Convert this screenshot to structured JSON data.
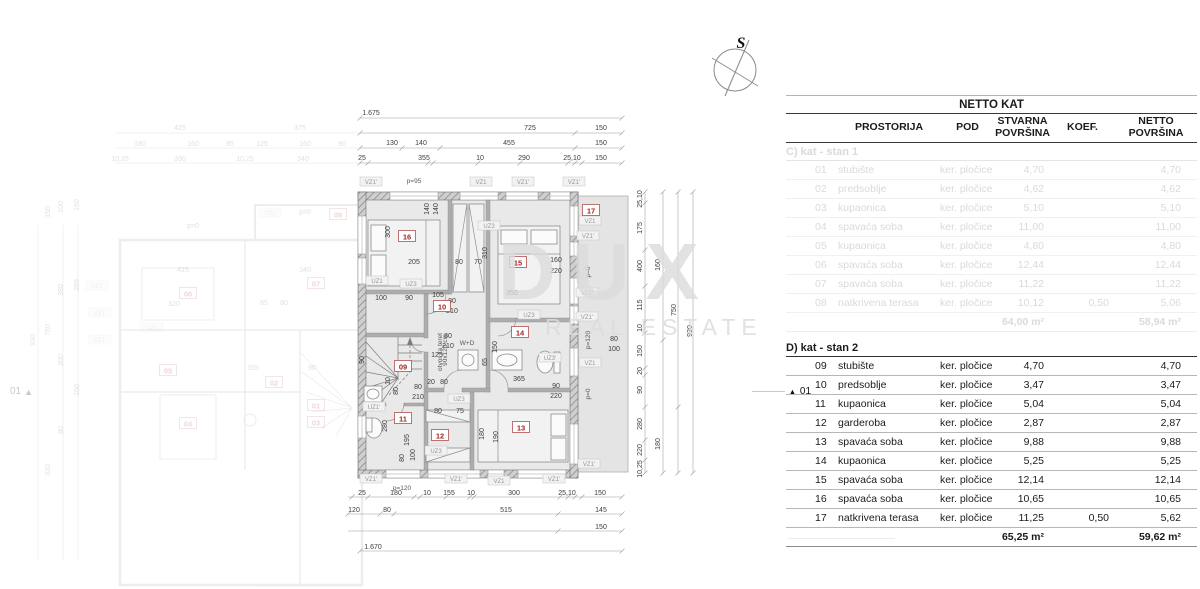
{
  "compass": {
    "label": "S"
  },
  "watermark": {
    "line1": "DUX",
    "line2": "REAL ESTATE"
  },
  "markers": {
    "triangle": "▲",
    "right_label": "01",
    "left_label": "01"
  },
  "table": {
    "title": "NETTO KAT",
    "columns": {
      "prostorija": "PROSTORIJA",
      "pod": "POD",
      "stvarna": "STVARNA POVRŠINA",
      "koef": "KOEF.",
      "netto": "NETTO POVRŠINA"
    },
    "sections": [
      {
        "heading": "C) kat - stan 1",
        "muted": true,
        "rows": [
          [
            "01",
            "stubište",
            "ker. pločice",
            "4,70",
            "",
            "4,70"
          ],
          [
            "02",
            "predsoblje",
            "ker. pločice",
            "4,62",
            "",
            "4,62"
          ],
          [
            "03",
            "kupaonica",
            "ker. pločice",
            "5,10",
            "",
            "5,10"
          ],
          [
            "04",
            "spavaća soba",
            "ker. pločice",
            "11,00",
            "",
            "11,00"
          ],
          [
            "05",
            "kupaonica",
            "ker. pločice",
            "4,80",
            "",
            "4,80"
          ],
          [
            "06",
            "spavaća soba",
            "ker. pločice",
            "12,44",
            "",
            "12,44"
          ],
          [
            "07",
            "spavaća soba",
            "ker. pločice",
            "11,22",
            "",
            "11,22"
          ],
          [
            "08",
            "natkrivena terasa",
            "ker. pločice",
            "10,12",
            "0,50",
            "5,06"
          ]
        ],
        "total_stvarna": "64,00 m²",
        "total_netto": "58,94 m²"
      },
      {
        "heading": "D) kat - stan 2",
        "muted": false,
        "rows": [
          [
            "09",
            "stubište",
            "ker. pločice",
            "4,70",
            "",
            "4,70"
          ],
          [
            "10",
            "predsoblje",
            "ker. pločice",
            "3,47",
            "",
            "3,47"
          ],
          [
            "11",
            "kupaonica",
            "ker. pločice",
            "5,04",
            "",
            "5,04"
          ],
          [
            "12",
            "garderoba",
            "ker. pločice",
            "2,87",
            "",
            "2,87"
          ],
          [
            "13",
            "spavaća soba",
            "ker. pločice",
            "9,88",
            "",
            "9,88"
          ],
          [
            "14",
            "kupaonica",
            "ker. pločice",
            "5,25",
            "",
            "5,25"
          ],
          [
            "15",
            "spavaća soba",
            "ker. pločice",
            "12,14",
            "",
            "12,14"
          ],
          [
            "16",
            "spavaća soba",
            "ker. pločice",
            "10,65",
            "",
            "10,65"
          ],
          [
            "17",
            "natkrivena terasa",
            "ker. pločice",
            "11,25",
            "0,50",
            "5,62"
          ]
        ],
        "total_stvarna": "65,25 m²",
        "total_netto": "59,62 m²"
      }
    ]
  },
  "plan": {
    "badges": [
      {
        "t": "09",
        "x": 403,
        "y": 368
      },
      {
        "t": "10",
        "x": 442,
        "y": 308
      },
      {
        "t": "11",
        "x": 403,
        "y": 420
      },
      {
        "t": "12",
        "x": 440,
        "y": 437
      },
      {
        "t": "13",
        "x": 521,
        "y": 429
      },
      {
        "t": "14",
        "x": 520,
        "y": 334
      },
      {
        "t": "15",
        "x": 518,
        "y": 264
      },
      {
        "t": "16",
        "x": 407,
        "y": 238
      },
      {
        "t": "17",
        "x": 591,
        "y": 212
      }
    ],
    "tags": [
      {
        "t": "VZ1'",
        "x": 371,
        "y": 184
      },
      {
        "t": "VZ1",
        "x": 481,
        "y": 184
      },
      {
        "t": "VZ1'",
        "x": 523,
        "y": 184
      },
      {
        "t": "VZ1'",
        "x": 574,
        "y": 184
      },
      {
        "t": "VZ1'",
        "x": 371,
        "y": 481
      },
      {
        "t": "VZ1'",
        "x": 456,
        "y": 481
      },
      {
        "t": "VZ1",
        "x": 499,
        "y": 483
      },
      {
        "t": "VZ1'",
        "x": 554,
        "y": 481
      },
      {
        "t": "VZ1",
        "x": 590,
        "y": 223
      },
      {
        "t": "VZ1'",
        "x": 588,
        "y": 238
      },
      {
        "t": "VZ1'",
        "x": 587,
        "y": 295
      },
      {
        "t": "VZ1'",
        "x": 587,
        "y": 319
      },
      {
        "t": "VZ1",
        "x": 590,
        "y": 365
      },
      {
        "t": "VZ1'",
        "x": 589,
        "y": 466
      },
      {
        "t": "UZ1",
        "x": 377,
        "y": 283
      },
      {
        "t": "UZ3",
        "x": 411,
        "y": 286
      },
      {
        "t": "UZ3",
        "x": 489,
        "y": 228
      },
      {
        "t": "UZ3",
        "x": 529,
        "y": 317
      },
      {
        "t": "UZ3'",
        "x": 550,
        "y": 360
      },
      {
        "t": "UZ1'",
        "x": 374,
        "y": 409
      },
      {
        "t": "UZ3",
        "x": 459,
        "y": 401
      },
      {
        "t": "UZ3",
        "x": 436,
        "y": 453
      }
    ],
    "dims": [
      {
        "t": "1.675",
        "x": 371,
        "y": 115
      },
      {
        "t": "725",
        "x": 530,
        "y": 130
      },
      {
        "t": "150",
        "x": 601,
        "y": 130
      },
      {
        "t": "130",
        "x": 392,
        "y": 145
      },
      {
        "t": "140",
        "x": 421,
        "y": 145
      },
      {
        "t": "455",
        "x": 509,
        "y": 145
      },
      {
        "t": "150",
        "x": 601,
        "y": 145
      },
      {
        "t": "25",
        "x": 362,
        "y": 160
      },
      {
        "t": "355",
        "x": 424,
        "y": 160
      },
      {
        "t": "10",
        "x": 480,
        "y": 160
      },
      {
        "t": "290",
        "x": 524,
        "y": 160
      },
      {
        "t": "25,10",
        "x": 572,
        "y": 160
      },
      {
        "t": "150",
        "x": 601,
        "y": 160
      },
      {
        "t": "25",
        "x": 362,
        "y": 495
      },
      {
        "t": "180",
        "x": 396,
        "y": 495
      },
      {
        "t": "10",
        "x": 427,
        "y": 495
      },
      {
        "t": "155",
        "x": 449,
        "y": 495
      },
      {
        "t": "10",
        "x": 471,
        "y": 495
      },
      {
        "t": "300",
        "x": 514,
        "y": 495
      },
      {
        "t": "25,10",
        "x": 567,
        "y": 495
      },
      {
        "t": "150",
        "x": 600,
        "y": 495
      },
      {
        "t": "120",
        "x": 354,
        "y": 512
      },
      {
        "t": "80",
        "x": 387,
        "y": 512
      },
      {
        "t": "515",
        "x": 506,
        "y": 512
      },
      {
        "t": "145",
        "x": 601,
        "y": 512
      },
      {
        "t": "150",
        "x": 601,
        "y": 529
      },
      {
        "t": "1.670",
        "x": 373,
        "y": 549
      },
      {
        "t": "25,10",
        "x": 642,
        "y": 199,
        "r": 1
      },
      {
        "t": "175",
        "x": 642,
        "y": 228,
        "r": 1
      },
      {
        "t": "400",
        "x": 642,
        "y": 266,
        "r": 1
      },
      {
        "t": "115",
        "x": 642,
        "y": 305,
        "r": 1
      },
      {
        "t": "10",
        "x": 642,
        "y": 328,
        "r": 1
      },
      {
        "t": "150",
        "x": 642,
        "y": 351,
        "r": 1
      },
      {
        "t": "20",
        "x": 642,
        "y": 371,
        "r": 1
      },
      {
        "t": "90",
        "x": 642,
        "y": 390,
        "r": 1
      },
      {
        "t": "280",
        "x": 642,
        "y": 424,
        "r": 1
      },
      {
        "t": "220",
        "x": 642,
        "y": 450,
        "r": 1
      },
      {
        "t": "10,25",
        "x": 642,
        "y": 469,
        "r": 1
      },
      {
        "t": "160",
        "x": 660,
        "y": 265,
        "r": 1
      },
      {
        "t": "180",
        "x": 660,
        "y": 444,
        "r": 1
      },
      {
        "t": "750",
        "x": 676,
        "y": 310,
        "r": 1
      },
      {
        "t": "930",
        "x": 692,
        "y": 331,
        "r": 1
      },
      {
        "t": "140",
        "x": 429,
        "y": 209,
        "r": 1
      },
      {
        "t": "140",
        "x": 438,
        "y": 209,
        "r": 1
      },
      {
        "t": "300",
        "x": 390,
        "y": 232,
        "r": 1
      },
      {
        "t": "205",
        "x": 414,
        "y": 264
      },
      {
        "t": "80",
        "x": 459,
        "y": 264
      },
      {
        "t": "70",
        "x": 478,
        "y": 264
      },
      {
        "t": "310",
        "x": 487,
        "y": 253,
        "r": 1
      },
      {
        "t": "350",
        "x": 512,
        "y": 295
      },
      {
        "t": "160",
        "x": 556,
        "y": 262
      },
      {
        "t": "220",
        "x": 556,
        "y": 273
      },
      {
        "t": "100",
        "x": 381,
        "y": 300
      },
      {
        "t": "90",
        "x": 409,
        "y": 300
      },
      {
        "t": "105",
        "x": 438,
        "y": 297
      },
      {
        "t": "80",
        "x": 452,
        "y": 303
      },
      {
        "t": "210",
        "x": 452,
        "y": 313
      },
      {
        "t": "80",
        "x": 448,
        "y": 338
      },
      {
        "t": "210",
        "x": 448,
        "y": 348
      },
      {
        "t": "125",
        "x": 437,
        "y": 357
      },
      {
        "t": "80",
        "x": 418,
        "y": 389
      },
      {
        "t": "210",
        "x": 418,
        "y": 399
      },
      {
        "t": "20",
        "x": 431,
        "y": 384
      },
      {
        "t": "80",
        "x": 444,
        "y": 384
      },
      {
        "t": "10",
        "x": 390,
        "y": 381,
        "r": 1
      },
      {
        "t": "80",
        "x": 398,
        "y": 391,
        "r": 1
      },
      {
        "t": "90",
        "x": 364,
        "y": 360,
        "r": 1
      },
      {
        "t": "150",
        "x": 497,
        "y": 347,
        "r": 1
      },
      {
        "t": "65",
        "x": 487,
        "y": 362,
        "r": 1
      },
      {
        "t": "365",
        "x": 519,
        "y": 381
      },
      {
        "t": "90",
        "x": 556,
        "y": 388
      },
      {
        "t": "220",
        "x": 556,
        "y": 398
      },
      {
        "t": "80",
        "x": 614,
        "y": 341
      },
      {
        "t": "100",
        "x": 614,
        "y": 351
      },
      {
        "t": "180",
        "x": 484,
        "y": 434,
        "r": 1
      },
      {
        "t": "190",
        "x": 498,
        "y": 437,
        "r": 1
      },
      {
        "t": "80",
        "x": 438,
        "y": 413
      },
      {
        "t": "75",
        "x": 460,
        "y": 413
      },
      {
        "t": "280",
        "x": 387,
        "y": 426,
        "r": 1
      },
      {
        "t": "195",
        "x": 409,
        "y": 440,
        "r": 1
      },
      {
        "t": "100",
        "x": 415,
        "y": 455,
        "r": 1
      },
      {
        "t": "80",
        "x": 404,
        "y": 458,
        "r": 1
      }
    ],
    "plabels": [
      {
        "t": "p=95",
        "x": 414,
        "y": 183
      },
      {
        "t": "p=120",
        "x": 402,
        "y": 490
      },
      {
        "t": "p=0",
        "x": 590,
        "y": 272,
        "r": 1
      },
      {
        "t": "p=120",
        "x": 590,
        "y": 340,
        "r": 1
      },
      {
        "t": "p=0",
        "x": 590,
        "y": 394,
        "r": 1
      },
      {
        "t": "W+D",
        "x": 467,
        "y": 345,
        "s": 5
      },
      {
        "t": "otvor za teret",
        "x": 442,
        "y": 352,
        "r": 1,
        "s": 4
      },
      {
        "t": "90x120 cm",
        "x": 447,
        "y": 350,
        "r": 1,
        "s": 4
      }
    ]
  },
  "bg_plan": {
    "badges": [
      {
        "t": "01",
        "x": 316,
        "y": 407
      },
      {
        "t": "02",
        "x": 274,
        "y": 384
      },
      {
        "t": "03",
        "x": 316,
        "y": 424
      },
      {
        "t": "04",
        "x": 188,
        "y": 425
      },
      {
        "t": "05",
        "x": 168,
        "y": 372
      },
      {
        "t": "06",
        "x": 188,
        "y": 295
      },
      {
        "t": "07",
        "x": 316,
        "y": 285
      },
      {
        "t": "08",
        "x": 338,
        "y": 216
      }
    ],
    "tags": [
      {
        "t": "VZ1",
        "x": 270,
        "y": 215
      },
      {
        "t": "VZ1'",
        "x": 97,
        "y": 288
      },
      {
        "t": "VZ1'",
        "x": 100,
        "y": 315
      },
      {
        "t": "VZ1'",
        "x": 100,
        "y": 342
      },
      {
        "t": "UZ1",
        "x": 152,
        "y": 330
      }
    ],
    "dims": [
      {
        "t": "425",
        "x": 180,
        "y": 130
      },
      {
        "t": "375",
        "x": 300,
        "y": 130
      },
      {
        "t": "180",
        "x": 140,
        "y": 146
      },
      {
        "t": "160",
        "x": 193,
        "y": 146
      },
      {
        "t": "85",
        "x": 230,
        "y": 146
      },
      {
        "t": "125",
        "x": 262,
        "y": 146
      },
      {
        "t": "160",
        "x": 305,
        "y": 146
      },
      {
        "t": "90",
        "x": 342,
        "y": 146
      },
      {
        "t": "10,25",
        "x": 120,
        "y": 161
      },
      {
        "t": "390",
        "x": 180,
        "y": 161
      },
      {
        "t": "10,25",
        "x": 245,
        "y": 161
      },
      {
        "t": "340",
        "x": 303,
        "y": 161
      },
      {
        "t": "150",
        "x": 50,
        "y": 212,
        "r": 1
      },
      {
        "t": "100",
        "x": 63,
        "y": 207,
        "r": 1
      },
      {
        "t": "160",
        "x": 79,
        "y": 205,
        "r": 1
      },
      {
        "t": "380",
        "x": 63,
        "y": 290,
        "r": 1
      },
      {
        "t": "265",
        "x": 79,
        "y": 285,
        "r": 1
      },
      {
        "t": "750",
        "x": 50,
        "y": 330,
        "r": 1
      },
      {
        "t": "930",
        "x": 35,
        "y": 340,
        "r": 1
      },
      {
        "t": "200",
        "x": 63,
        "y": 360,
        "r": 1
      },
      {
        "t": "150",
        "x": 79,
        "y": 390,
        "r": 1
      },
      {
        "t": "80",
        "x": 63,
        "y": 430,
        "r": 1
      },
      {
        "t": "320",
        "x": 50,
        "y": 470,
        "r": 1
      },
      {
        "t": "415",
        "x": 183,
        "y": 272
      },
      {
        "t": "340",
        "x": 305,
        "y": 272
      },
      {
        "t": "320",
        "x": 174,
        "y": 306
      },
      {
        "t": "65",
        "x": 264,
        "y": 305
      },
      {
        "t": "80",
        "x": 284,
        "y": 305
      },
      {
        "t": "155",
        "x": 253,
        "y": 370
      },
      {
        "t": "90",
        "x": 312,
        "y": 370
      },
      {
        "t": "p=0",
        "x": 193,
        "y": 228
      },
      {
        "t": "p=0",
        "x": 305,
        "y": 214
      }
    ]
  }
}
